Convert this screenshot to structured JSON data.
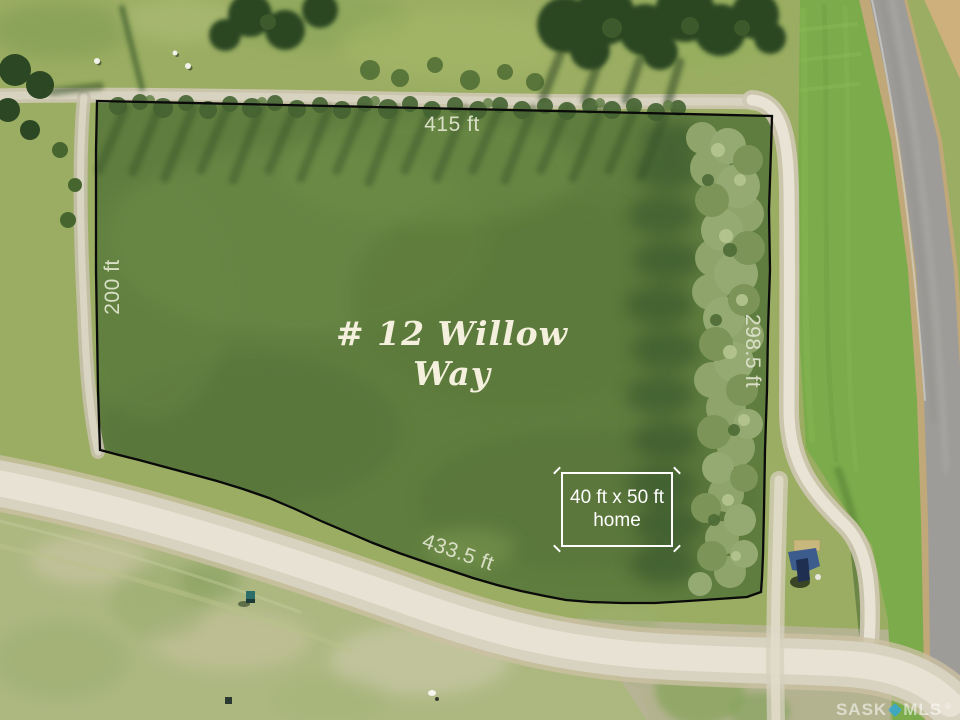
{
  "annotations": {
    "top_dimension": "415 ft",
    "left_dimension": "200 ft",
    "right_dimension": "298.5 ft",
    "bottom_dimension": "433.5 ft",
    "lot_title": "# 12 Willow Way",
    "home_box_line1": "40 ft x 50 ft",
    "home_box_line2": "home"
  },
  "watermark": {
    "brand_left": "SASK",
    "brand_right": "MLS",
    "registered": "®"
  },
  "palette": {
    "lot_grass": "#5f7d3e",
    "outer_grass": "#9aad62",
    "pale_grass": "#adb881",
    "ditch_grass": "#7cab4c",
    "gravel_light": "#e8e3d5",
    "gravel_mid": "#d8d2c0",
    "gravel_edge": "#cbc0a2",
    "asphalt": "#9e9c98",
    "shoulder_tan": "#c0a878",
    "tree_dark": "#2c4723",
    "tree_sage": "#94aa72",
    "boundary_line": "#0a0a0a",
    "dimension_text": "#dfe4cd",
    "title_text": "#f4f0dd",
    "home_box_white": "#ffffff",
    "watermark_diamond": "#35a7d4",
    "shed_blue": "#3d5c8e"
  }
}
